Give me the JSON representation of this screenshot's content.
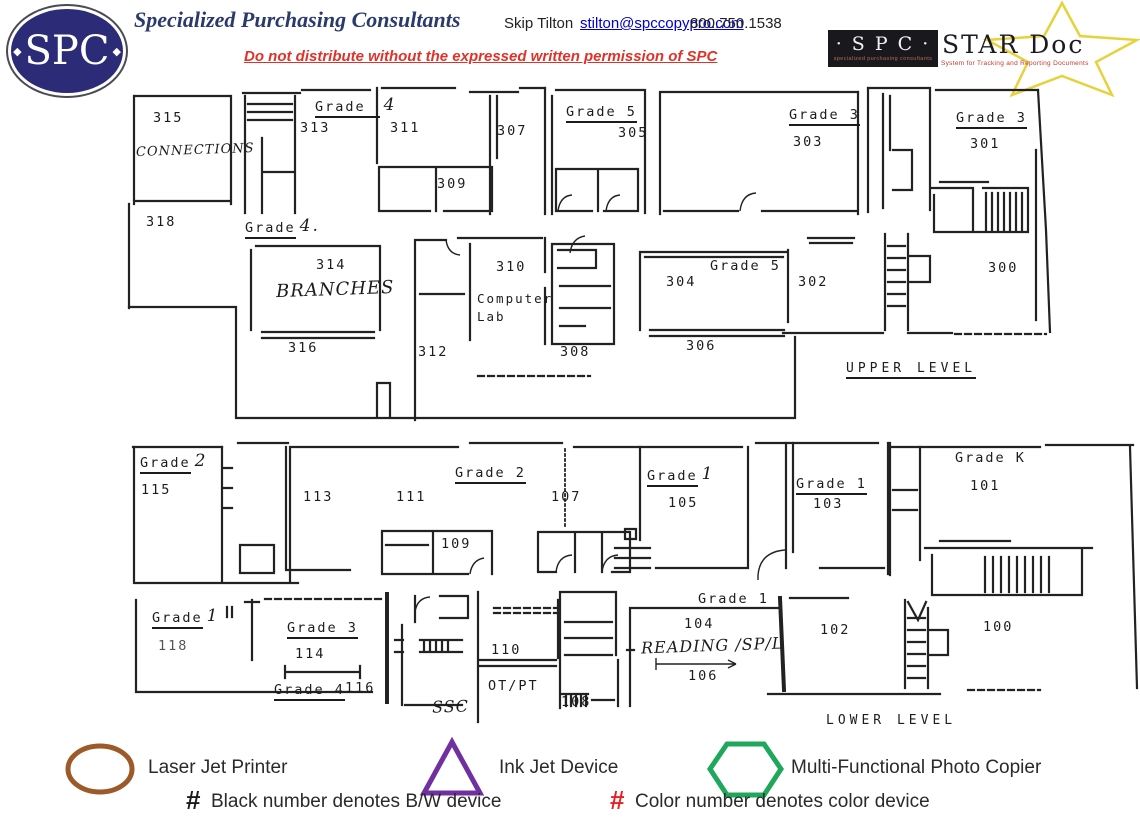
{
  "header": {
    "logo": {
      "text": "SPC",
      "left_diamond": "◆",
      "right_diamond": "◆"
    },
    "company": "Specialized Purchasing Consultants",
    "contact_name": "Skip Tilton",
    "email": "stilton@spccopypro.com",
    "phone": "800.750.1538",
    "warning": "Do not distribute without the expressed written permission of SPC",
    "stardoc": {
      "spc": "· S P C ·",
      "spc_tagline": "specialized purchasing consultants",
      "name": "STAR Doc",
      "subtitle": "System for Tracking and Reporting Documents"
    }
  },
  "plan": {
    "upper": {
      "level_label": "UPPER LEVEL",
      "labels": {
        "r315": "315",
        "connections": "CONNECTIONS",
        "grade_313_word": "Grade",
        "grade_313_num": "4",
        "r313": "313",
        "r311": "311",
        "r309": "309",
        "r307": "307",
        "grade_305": "Grade 5",
        "r305": "305",
        "grade_303": "Grade 3",
        "r303": "303",
        "grade_301": "Grade 3",
        "r301": "301",
        "r318": "318",
        "grade_314_word": "Grade",
        "grade_314_num": "4.",
        "r314": "314",
        "branches": "BRANCHES",
        "r316": "316",
        "r310": "310",
        "computer_lab": "Computer Lab",
        "r312": "312",
        "r308": "308",
        "grade_304": "Grade 5",
        "r304": "304",
        "r302": "302",
        "r300": "300",
        "r306": "306"
      }
    },
    "lower": {
      "level_label": "LOWER LEVEL",
      "labels": {
        "grade_115_word": "Grade",
        "grade_115_num": "2",
        "r115": "115",
        "r113": "113",
        "r111": "111",
        "grade_107": "Grade 2",
        "r107": "107",
        "r109": "109",
        "grade_105_word": "Grade",
        "grade_105_num": "1",
        "r105": "105",
        "grade_103": "Grade 1",
        "r103": "103",
        "grade_101": "Grade K",
        "r101": "101",
        "grade_118_word": "Grade",
        "grade_118_num": "1",
        "r118": "118",
        "grade_114": "Grade 3",
        "r114": "114",
        "grade_116": "Grade 4",
        "r116": "116",
        "ssc": "SSC",
        "r110": "110",
        "otpt": "OT/PT",
        "r108": "108",
        "grade_104": "Grade 1",
        "r104": "104",
        "reading": "READING /SP/L",
        "r106": "106",
        "r102": "102",
        "r100": "100"
      }
    }
  },
  "legend": {
    "laser": {
      "label": "Laser Jet Printer",
      "color": "#9c5a28"
    },
    "inkjet": {
      "label": "Ink Jet Device",
      "color": "#7030a0"
    },
    "copier": {
      "label": "Multi-Functional Photo Copier",
      "color": "#1fa85c"
    },
    "bw_note": {
      "symbol": "#",
      "text": "Black number denotes B/W device",
      "color": "#1a1a1a"
    },
    "color_note": {
      "symbol": "#",
      "text": "Color number denotes color device",
      "color": "#ed1c24"
    }
  }
}
